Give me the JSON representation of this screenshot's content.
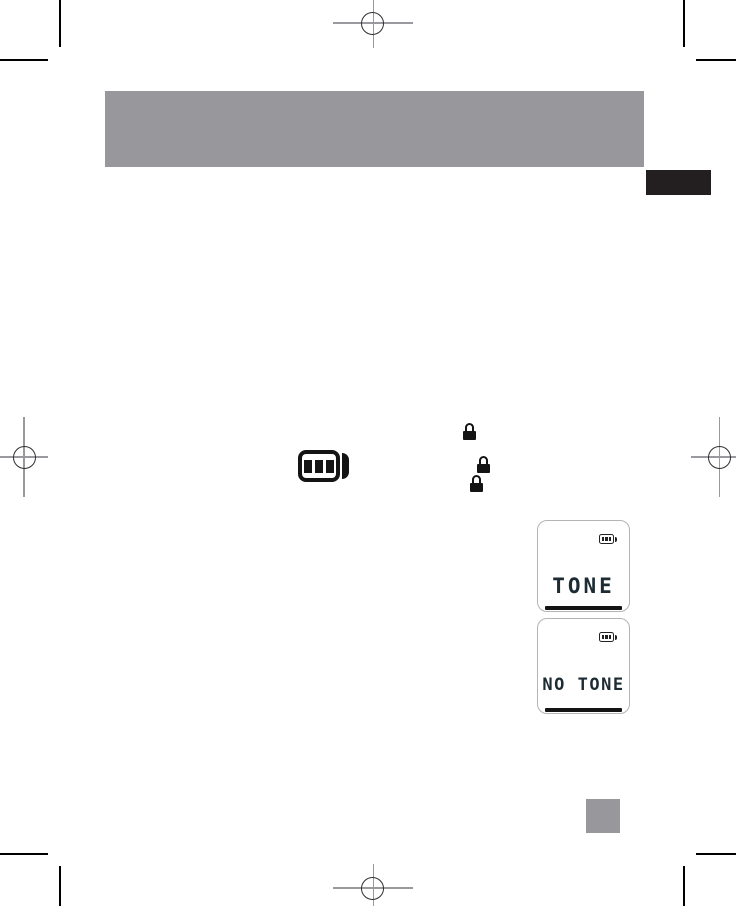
{
  "document": {
    "kind": "device-manual print proof page"
  },
  "colors": {
    "header_bar": "#98989c",
    "side_tab": "#231f20",
    "page_number_block": "#98989c",
    "icon_black": "#141414",
    "lcd_text": "#1d2b33",
    "lcd_border": "#b4b4b7",
    "crop_mark": "#000000",
    "registration_line": "#9a9a9e",
    "registration_circle": "#2f2f31"
  },
  "icons": {
    "battery_large": "battery-level-3-icon",
    "lock_icons_count": 3,
    "lcd_battery": "battery-level-3-icon"
  },
  "displays": [
    {
      "text": "TONE"
    },
    {
      "text": "NO TONE"
    }
  ]
}
